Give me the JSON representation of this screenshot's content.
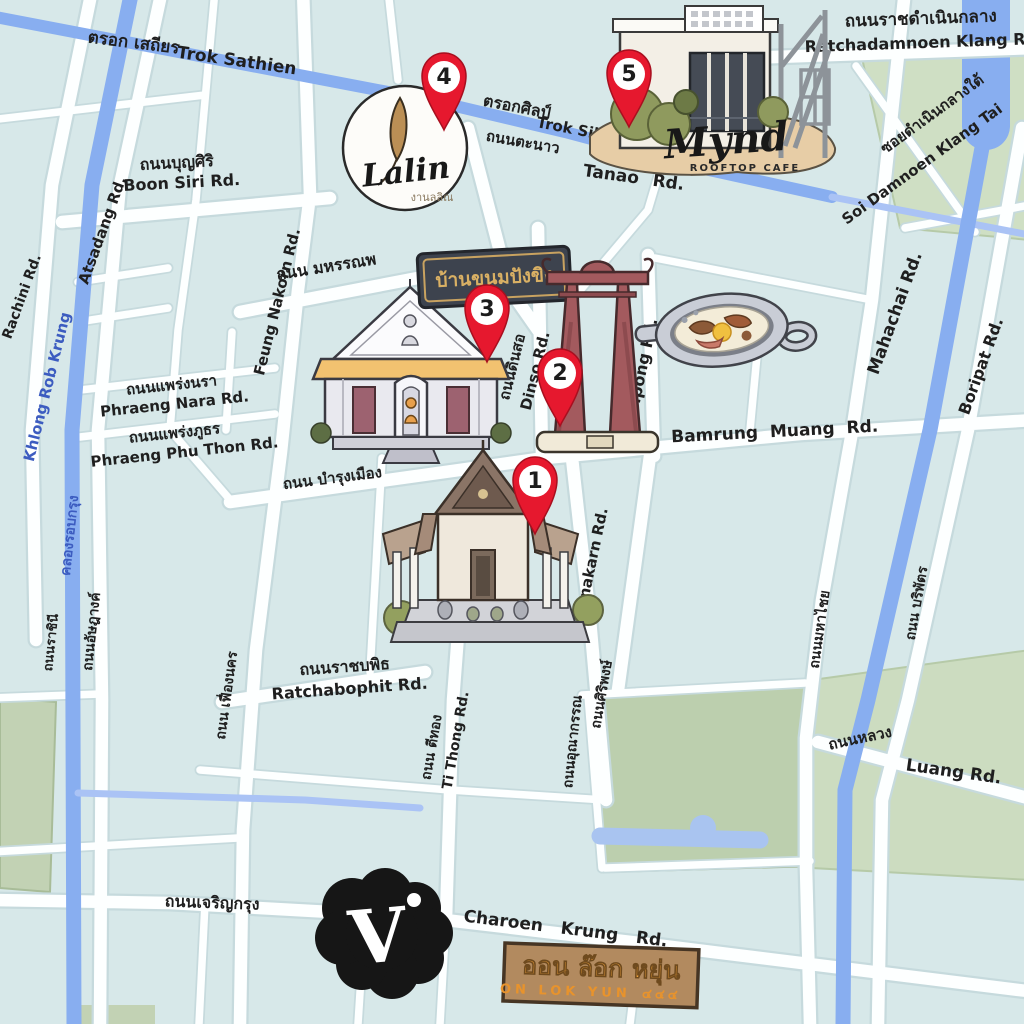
{
  "title": "Illustrated map of Bangkok old town cafes and landmarks",
  "colors": {
    "background": "#d9eaea",
    "road": "#fdffff",
    "road_casing": "#c6dadd",
    "canal": "#88aef0",
    "green": "#c2d2b4",
    "pin_red": "#e6182e",
    "label": "#1f1f1f",
    "canal_label": "#3c5cc0",
    "sign_dark": "#3d434e",
    "sign_gold": "#d9b064",
    "sign_brown": "#b28a5f",
    "sign_orange": "#f2a33c"
  },
  "pins": [
    {
      "number": "1"
    },
    {
      "number": "2"
    },
    {
      "number": "3"
    },
    {
      "number": "4"
    },
    {
      "number": "5"
    }
  ],
  "landmarks": {
    "lalin": {
      "name": "Lalin",
      "subtitle": "งานลลิณ"
    },
    "mynd": {
      "name": "Mynd",
      "subtitle": "ROOFTOP CAFE"
    },
    "gingerbread_sign": {
      "text": "บ้านขนมปังขิง"
    },
    "on_lok_yun": {
      "th": "ออน ล๊อก หยุ่น",
      "en": "ON LOK YUN",
      "number": "๔๔๔"
    },
    "v_logo": {
      "letter": "V"
    }
  },
  "roads": {
    "trok_sathien": {
      "th": "ตรอก เสถียร",
      "en": "Trok Sathien"
    },
    "ratchadamnoen": {
      "th": "ถนนราชดำเนินกลาง",
      "en": "Ratchadamnoen Klang Rd."
    },
    "soi_damnoen_klang_tai": {
      "th": "ซอยดำเนินกลางใต้",
      "en": "Soi Damnoen Klang Tai"
    },
    "trok_silp": {
      "th": "ตรอกศิลป์",
      "en": "Trok Silp"
    },
    "tanao": {
      "th": "ถนนตะนาว",
      "en": "Tanao Rd."
    },
    "boon_siri": {
      "th": "ถนนบุญศิริ",
      "en": "Boon Siri Rd."
    },
    "atsadang": {
      "th": "ถนนอัษฎางค์",
      "en": "Atsadang Rd."
    },
    "rachini": {
      "th": "ถนนราชินี",
      "en": "Rachini Rd."
    },
    "khlong_rob_krung": {
      "th": "คลองรอบกรุง",
      "en": "Khlong Rob Krung"
    },
    "mahannop": {
      "th": "ถนน มหรรณพ"
    },
    "feung_nakorn": {
      "th": "ถนน เฟื่องนคร",
      "en": "Feung Nakorn Rd."
    },
    "phraeng_nara": {
      "th": "ถนนแพร่งนรา",
      "en": "Phraeng Nara Rd."
    },
    "phraeng_phu_thon": {
      "th": "ถนนแพร่งภูธร",
      "en": "Phraeng Phu Thon Rd."
    },
    "dinso": {
      "th": "ถนนดินสอ",
      "en": "Dinso Rd."
    },
    "siripong": {
      "th": "ถนนศิริพงษ์",
      "en": "Siripong Rd."
    },
    "bamrung_muang": {
      "th": "ถนน บำรุงเมือง",
      "en": "Bamrung Muang Rd."
    },
    "mahachai": {
      "th": "ถนนมหาไชย",
      "en": "Mahachai Rd."
    },
    "boripat": {
      "th": "ถนน บริพัตร",
      "en": "Boripat Rd."
    },
    "unakarn": {
      "th": "ถนนอุณากรรณ",
      "en": "Unakarn Rd."
    },
    "ti_thong": {
      "th": "ถนน ตีทอง",
      "en": "Ti Thong Rd."
    },
    "ratchabophit": {
      "th": "ถนนราชบพิธ",
      "en": "Ratchabophit Rd."
    },
    "luang": {
      "th": "ถนนหลวง",
      "en": "Luang Rd."
    },
    "charoen_krung": {
      "th": "ถนนเจริญกรุง",
      "en": "Charoen Krung Rd."
    }
  }
}
